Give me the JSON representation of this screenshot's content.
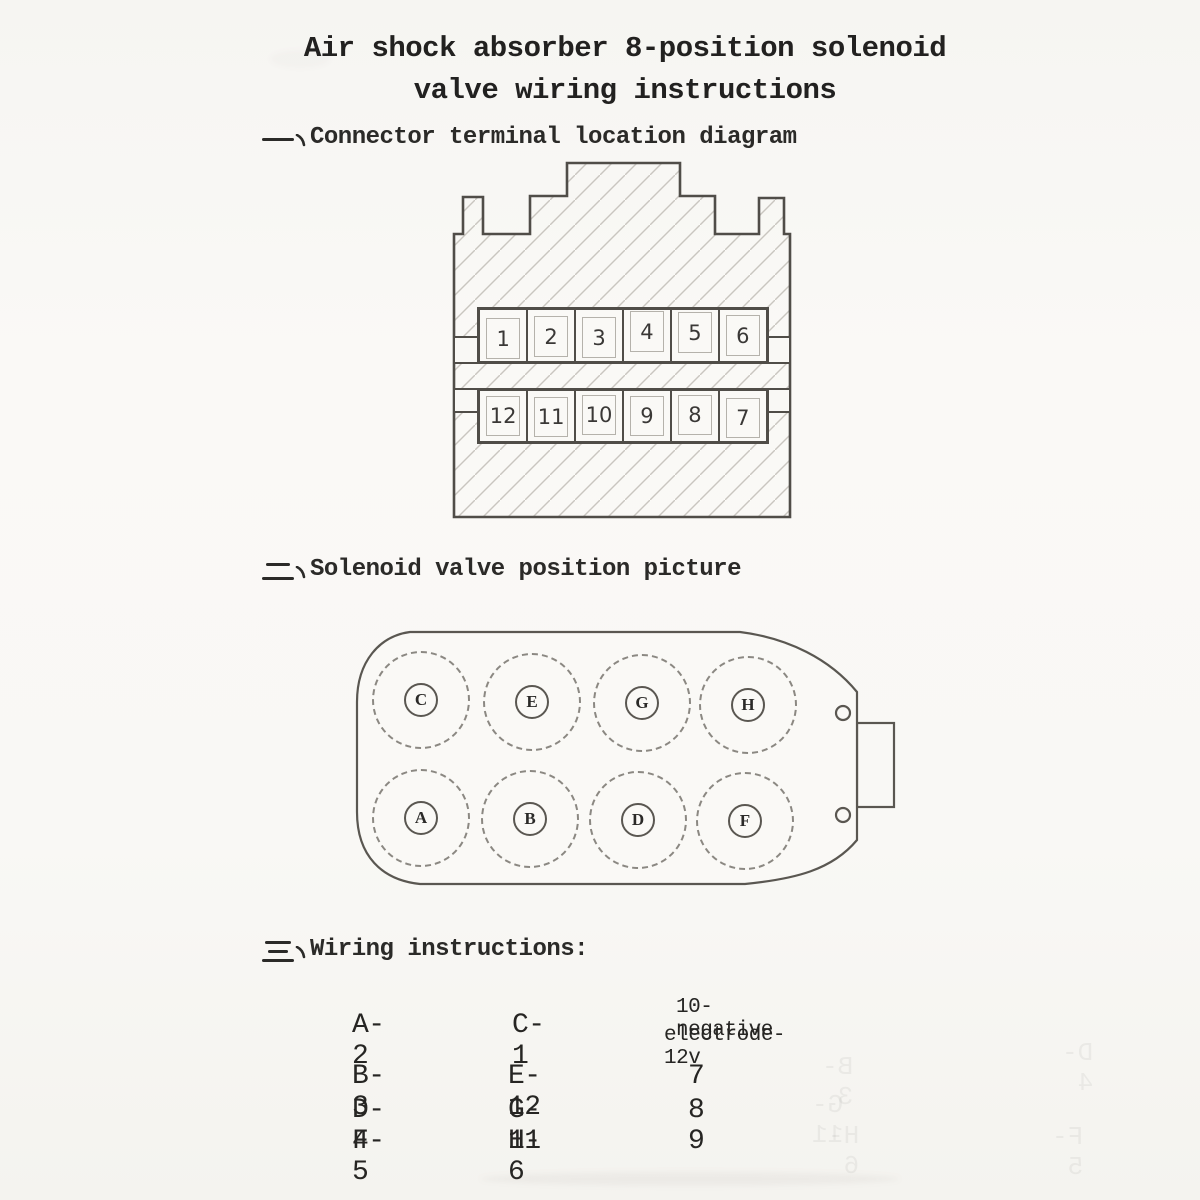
{
  "page": {
    "title_line1": "Air shock absorber 8-position solenoid",
    "title_line2": "valve wiring instructions",
    "paper_color": "#f9f8f5",
    "ink_color": "#2b2a28",
    "diagram_line_color": "#55514c",
    "hatch_color": "#c9c6c0"
  },
  "sections": {
    "one": {
      "marker": "一、",
      "heading": "Connector terminal location diagram"
    },
    "two": {
      "marker": "二、",
      "heading": "Solenoid valve position picture"
    },
    "three": {
      "marker": "三、",
      "heading": "Wiring instructions:"
    }
  },
  "connector": {
    "top_terminals": [
      "1",
      "2",
      "3",
      "4",
      "5",
      "6"
    ],
    "bottom_terminals": [
      "12",
      "11",
      "10",
      "9",
      "8",
      "7"
    ]
  },
  "valve": {
    "top_solenoids": [
      "C",
      "E",
      "G",
      "H"
    ],
    "bottom_solenoids": [
      "A",
      "B",
      "D",
      "F"
    ]
  },
  "wiring": {
    "column1": [
      "A-2",
      "B-3",
      "D-4",
      "F-5"
    ],
    "column2": [
      "C-1",
      "E-12",
      "G-11",
      "H-6"
    ],
    "column3_note": [
      "10-negative",
      "electrode-12v"
    ],
    "column3_values": [
      "7",
      "8",
      "9"
    ]
  },
  "bleed_through_texts": [
    "B-3",
    "G-11",
    "H-6",
    "F-5",
    "D-4"
  ]
}
